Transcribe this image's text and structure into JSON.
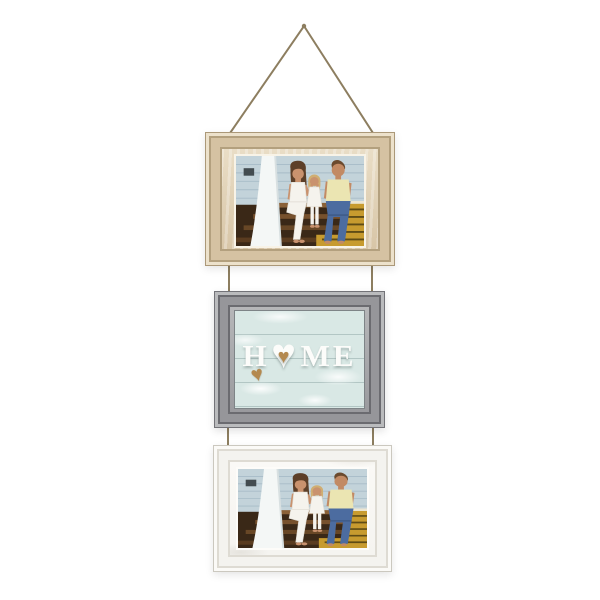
{
  "scene": {
    "type": "product photograph",
    "subject": "three-tier hanging picture frame collage on jute rope",
    "background": "#ffffff"
  },
  "sign": {
    "letter_h": "H",
    "letters_me": "ME",
    "heart_glyph": "♥"
  },
  "frames": [
    {
      "position": "top",
      "finish": "whitewashed natural wood",
      "content": "family photo on porch steps"
    },
    {
      "position": "middle",
      "finish": "distressed gray wood",
      "content": "HOME heart sign on light blue shiplap"
    },
    {
      "position": "bottom",
      "finish": "distressed white wood",
      "content": "family photo on porch steps"
    }
  ],
  "colors": {
    "bg": "#ffffff",
    "rope": "#8d7e60",
    "tan_edge": "#ab9878",
    "tan_face": "#d5c2a2",
    "tan_light": "#ece1cb",
    "tan_dark": "#b3a07e",
    "cream_lip": "#f8f3e7",
    "gray_edge": "#737378",
    "gray_face": "#96969a",
    "gray_light": "#babbbd",
    "gray_dark": "#6b6b70",
    "panel_blue": "#d9e8e5",
    "panel_line": "#b2c6c4",
    "sign_white": "#fcfcfa",
    "heart_brown": "#b4894f",
    "white_face": "#f4f3ef",
    "white_edge": "#cbc8bf",
    "white_shade": "#dedbd3",
    "white_lip": "#fdfcf9",
    "photo_siding": "#c3d3da",
    "photo_siding_line": "#a7bcc7",
    "photo_vent": "#434c50",
    "photo_curtain": "#f4f7f6",
    "photo_curtain_shade": "#d8e0e1",
    "photo_step_dark": "#3a2817",
    "photo_tread1": "#8a6138",
    "photo_tread2": "#77512d",
    "photo_tread3": "#684726",
    "photo_tread4": "#5a3c20",
    "photo_rug": "#c79b2f",
    "photo_rug_stripe": "#5f4c16",
    "photo_rug_edge": "#ece6d2",
    "skin": "#c9926e",
    "skin_dad": "#c28a64",
    "hair_brown": "#5d3f28",
    "hair_dad": "#6b4a2e",
    "hair_blonde": "#d0ae72",
    "white_cloth": "#f5f3ed",
    "cloth_shade": "#ddd9d0",
    "shirt_yellow": "#ebe5b2",
    "jeans": "#4c6ca0",
    "jeans_dark": "#3c5886"
  }
}
